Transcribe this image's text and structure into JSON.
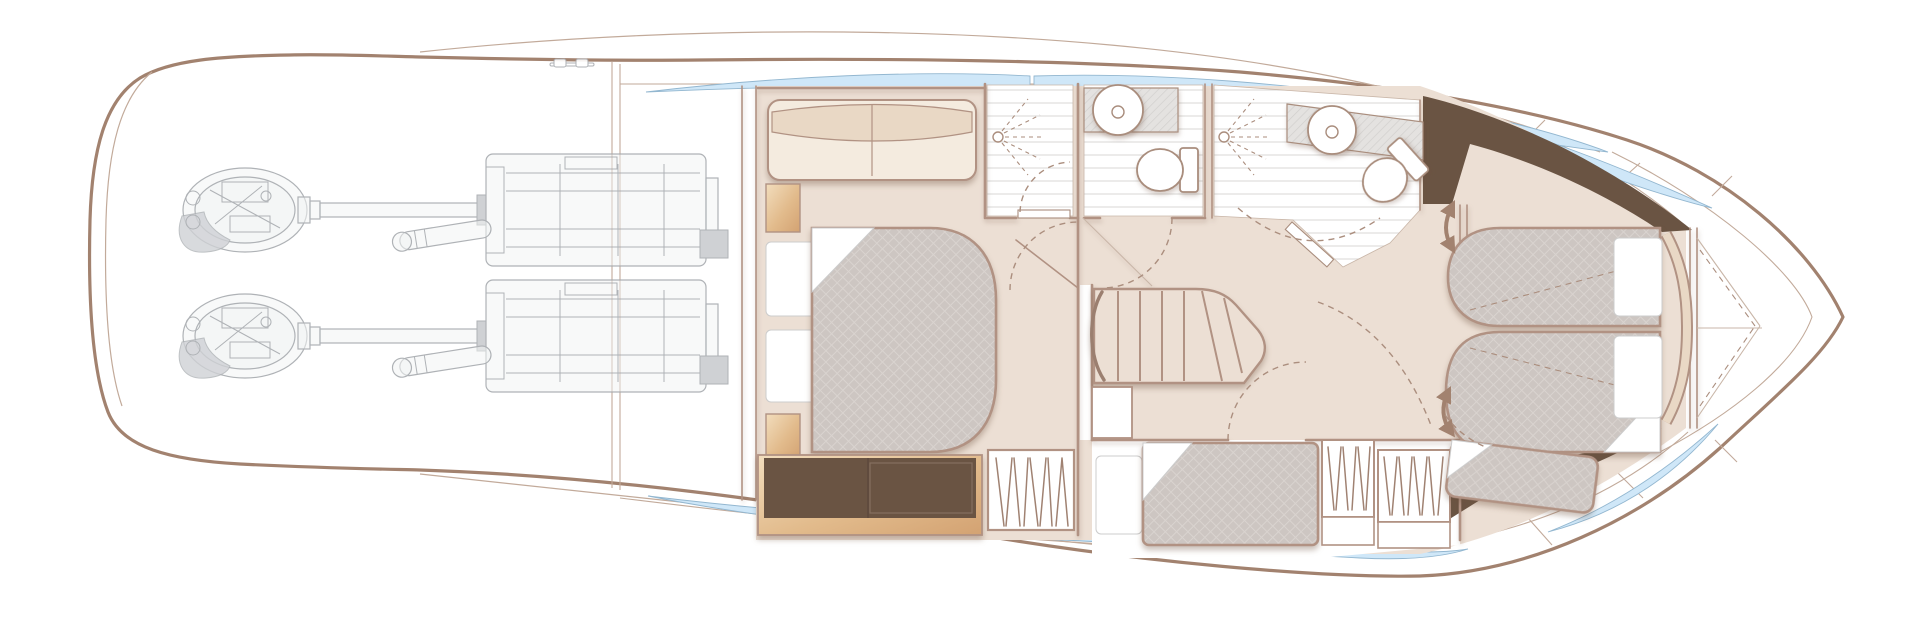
{
  "meta": {
    "description": "Motor yacht lower-deck accommodation floor plan drawing, bow pointing right; no text labels are rendered in the image."
  },
  "palette": {
    "bg": "#ffffff",
    "hull": "#a2826f",
    "hullThin": "#c2aa9a",
    "wall": "#b19283",
    "floor": "#ecdfd4",
    "quiltBase": "#cdc6c2",
    "quiltLine": "#d9d3cf",
    "cream": "#f4ebdf",
    "creamDark": "#e9d8c5",
    "woodL": "#f2ddbd",
    "woodM": "#e2bb8c",
    "woodD": "#d3a272",
    "cab": "#6a5443",
    "cabPanel": "#86705f",
    "wedge": "#6a5443",
    "glass": "#cfe7f8",
    "glassEdge": "#93b7d0",
    "engLine": "#a6aaae",
    "engFill": "#f0f2f3",
    "engFill2": "#caccd0",
    "stripe": "#e0dfde",
    "hatchBg": "#e4e2e0",
    "hatchLine": "#d1cfcd",
    "dash": "#ab8e7e",
    "fix": "#ffffff",
    "fixEdge": "#a98d7d",
    "arrow": "#a2826f",
    "seam": "#c9b6a8",
    "railDark": "#9b7f70",
    "pillowEdge": "#cccccc",
    "zig": "#a08272"
  },
  "diagram": {
    "type": "floor-plan",
    "subject": "motor-yacht-lower-deck",
    "orientation": "bow-right",
    "rooms": [
      "engine-room",
      "aft-cabin",
      "aft-ensuite-shower",
      "aft-head",
      "forward-head",
      "midships-landing",
      "staircase",
      "mid-cabin",
      "forward-cabin",
      "bow-anchor-locker"
    ],
    "furniture_icons": [
      "sofa-icon",
      "double-berth-icon",
      "pillow-icon",
      "nightstand-icon",
      "dresser-icon",
      "hanging-locker-icon",
      "vanity-counter-icon",
      "bench-berth-icon",
      "headboard-icon"
    ],
    "fixture_icons": [
      "shower-spray-icon",
      "sink-icon",
      "toilet-icon",
      "door-swing-arc-icon",
      "stair-treads-icon",
      "double-headed-arrow-icon",
      "hull-window-icon",
      "pod-drive-icon",
      "engine-block-icon",
      "cleat-icon"
    ]
  }
}
